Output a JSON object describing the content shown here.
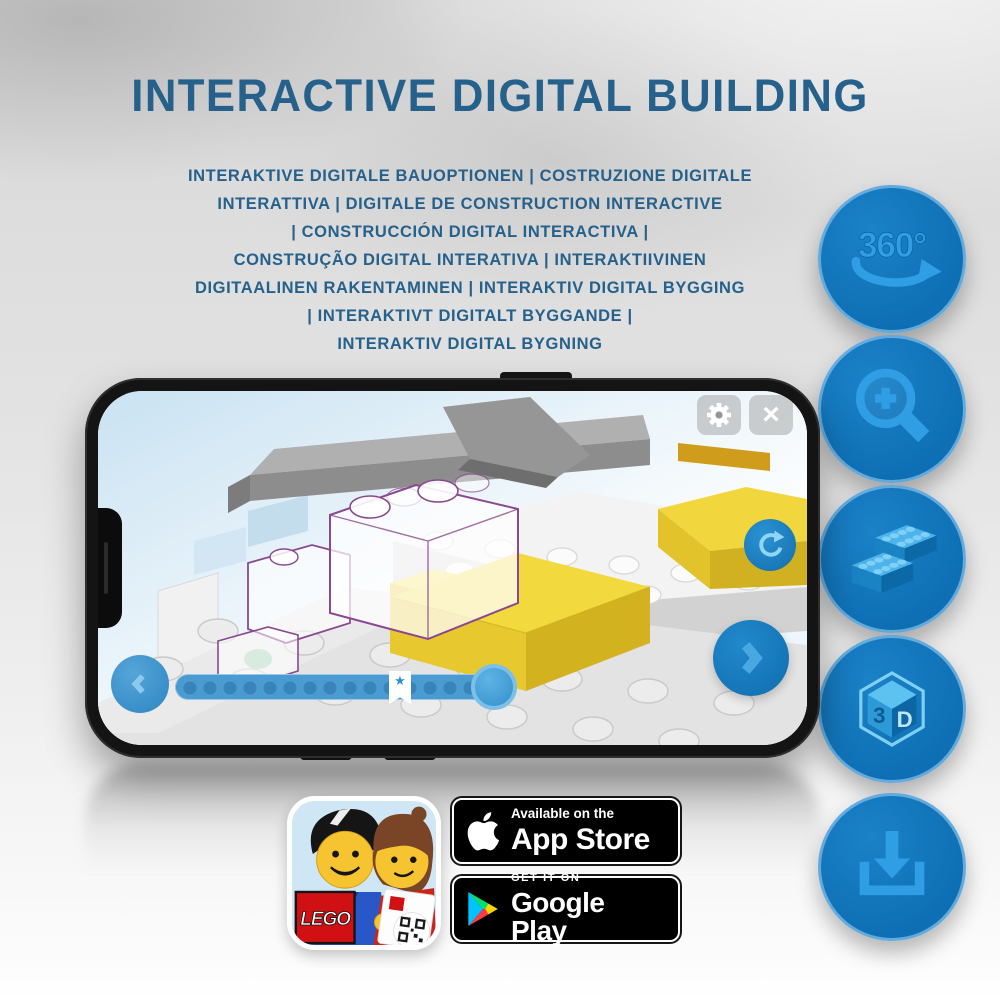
{
  "title": "INTERACTIVE DIGITAL BUILDING",
  "subtitle": {
    "lines": [
      "INTERAKTIVE DIGITALE BAUOPTIONEN | COSTRUZIONE DIGITALE",
      "INTERATTIVA | DIGITALE DE CONSTRUCTION INTERACTIVE",
      "| CONSTRUCCIÓN DIGITAL INTERACTIVA |",
      "CONSTRUÇÃO DIGITAL INTERATIVA | INTERAKTIIVINEN",
      "DIGITAALINEN RAKENTAMINEN | INTERAKTIV DIGITAL BYGGING",
      "| INTERAKTIVT DIGITALT BYGGANDE |",
      "INTERAKTIV DIGITAL BYGNING"
    ]
  },
  "features": {
    "rotate_label": "360°",
    "cube_left": "3",
    "cube_right": "D",
    "icons": [
      "360-rotate-icon",
      "zoom-in-icon",
      "bricks-icon",
      "3d-cube-icon",
      "download-icon"
    ]
  },
  "phone": {
    "close_glyph": "×",
    "progress_star": "★"
  },
  "app_icon": {
    "logo_text": "LEGO"
  },
  "badges": {
    "app_store": {
      "line1": "Available on the",
      "line2": "App Store"
    },
    "google_play": {
      "line1": "GET IT ON",
      "line2": "Google Play"
    }
  },
  "colors": {
    "title_blue": "#26618C",
    "circle_fill": "#0F72B8",
    "icon_blue": "#38A5E6",
    "lego_yellow": "#F2D93D",
    "ghost_outline": "#8A4890",
    "progress_blue": "#4A9BD2"
  }
}
